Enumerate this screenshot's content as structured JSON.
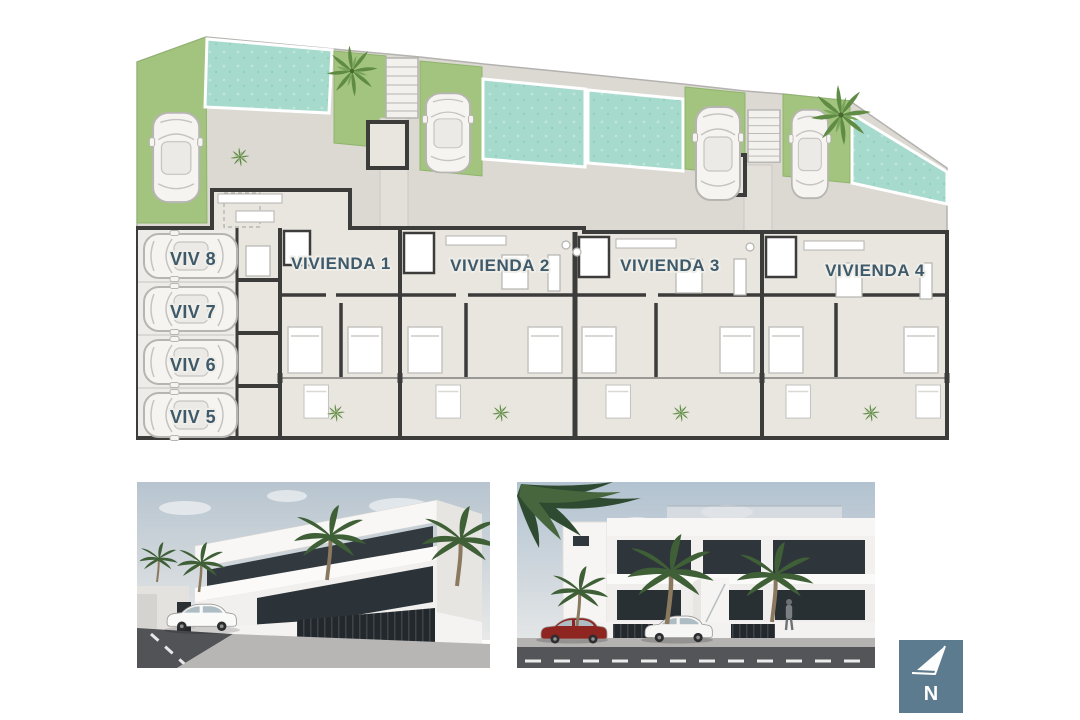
{
  "floor_plan": {
    "units": [
      {
        "label": "VIVIENDA 1"
      },
      {
        "label": "VIVIENDA 2"
      },
      {
        "label": "VIVIENDA 3"
      },
      {
        "label": "VIVIENDA 4"
      }
    ],
    "parking_spots": [
      {
        "label": "VIV 8"
      },
      {
        "label": "VIV 7"
      },
      {
        "label": "VIV 6"
      },
      {
        "label": "VIV 5"
      }
    ],
    "colors": {
      "grass": "#a3c47e",
      "pool_water": "#a6dacc",
      "pavement": "#dcd9d3",
      "interior_floor": "#e9e6e0",
      "walls": "#3c3c3b",
      "label_text": "#3e5a6a"
    }
  },
  "compass": {
    "icon": "north-arrow-icon",
    "letter": "N",
    "background": "#5d7b8e"
  }
}
